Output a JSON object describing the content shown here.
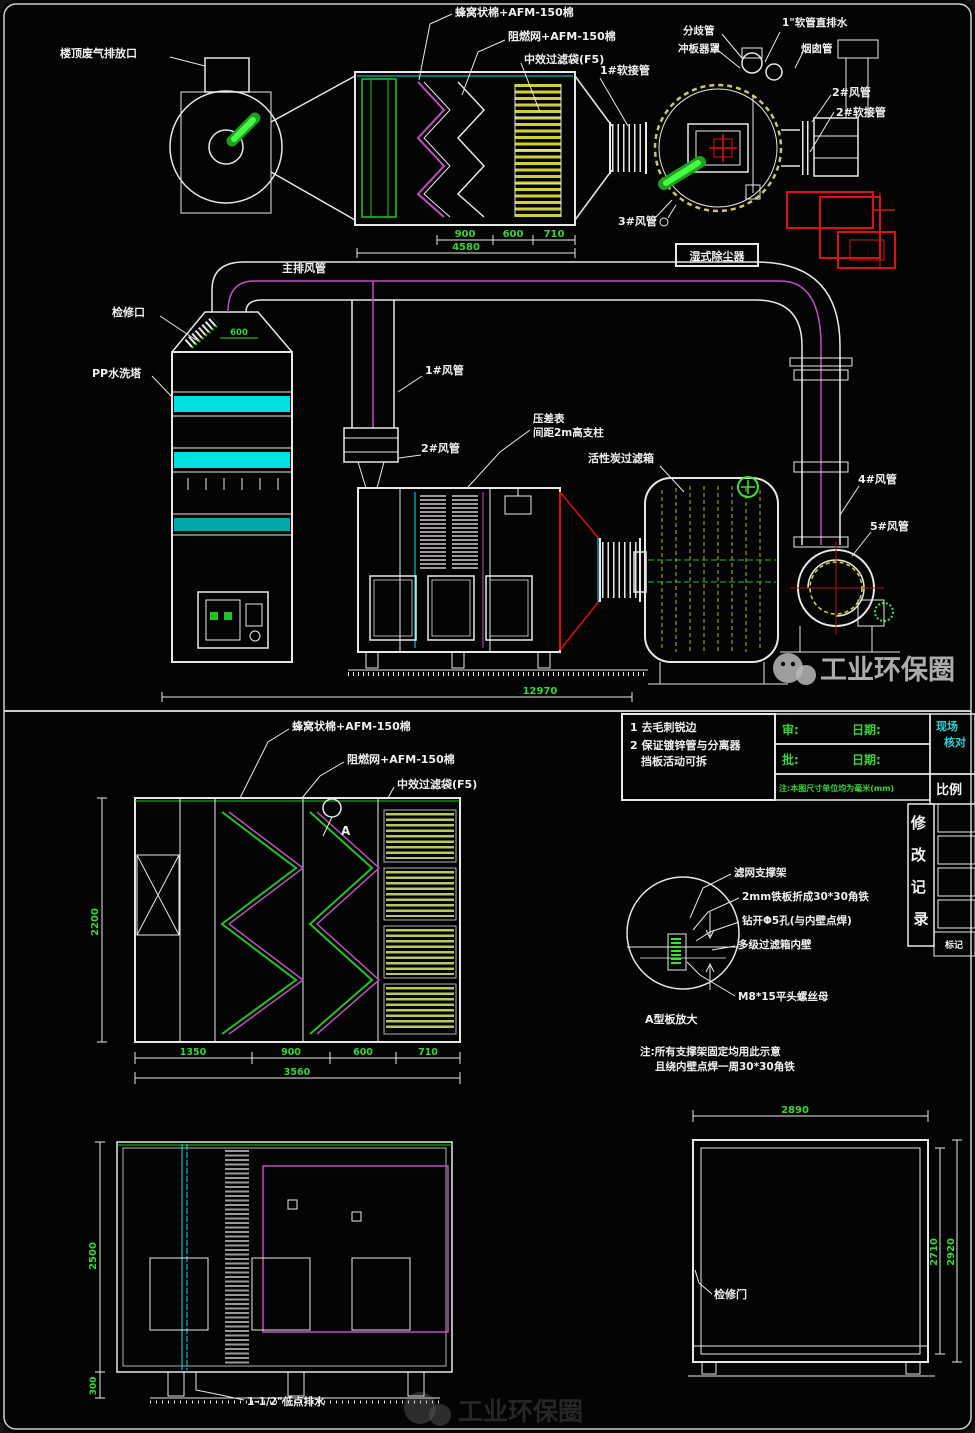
{
  "watermark": {
    "brand": "工业环保圈"
  },
  "top_view": {
    "labels": {
      "roof_outlet": "楼顶废气排放口",
      "honeycomb": "蜂窝状棉+AFM-150棉",
      "flame_net": "阻燃网+AFM-150棉",
      "mid_bag": "中效过滤袋(F5)",
      "soft1": "1#软接管",
      "branch": "分歧管",
      "baffle_cover": "冲板器罩",
      "drain_hose": "1\"软管直排水",
      "chimney": "烟囱管",
      "duct2": "2#风管",
      "soft2": "2#软接管",
      "duct3": "3#风管",
      "tag": "湿式除尘器"
    },
    "dims": {
      "a": "900",
      "b": "600",
      "c": "710",
      "total": "4580"
    }
  },
  "system_view": {
    "labels": {
      "main_duct": "主排风管",
      "hatch": "检修口",
      "tower": "PP水洗塔",
      "duct1": "1#风管",
      "gauge_line1": "压差表",
      "gauge_line2": "间距2m高支柱",
      "duct2": "2#风管",
      "carbon_box": "活性炭过滤箱",
      "duct4": "4#风管",
      "duct5": "5#风管"
    },
    "dims": {
      "hood": "600",
      "total": "12970"
    }
  },
  "notes_block": {
    "line1": "1 去毛刺锐边",
    "line2": "2 保证镀锌管与分离器",
    "line3": "挡板活动可拆"
  },
  "title_block": {
    "review": "审:",
    "date1": "日期:",
    "approve": "批:",
    "date2": "日期:",
    "green_note": "注:本图尺寸单位均为毫米(mm)",
    "scale": "比例",
    "corner_line1": "现场",
    "corner_line2": "核对",
    "revision_chars": [
      "修",
      "改",
      "记",
      "录"
    ],
    "mark": "标记"
  },
  "elevation_view": {
    "labels": {
      "honeycomb": "蜂窝状棉+AFM-150棉",
      "flame_net": "阻燃网+AFM-150棉",
      "mid_bag": "中效过滤袋(F5)",
      "marker": "A"
    },
    "dims": {
      "height": "2200",
      "a": "1350",
      "b": "900",
      "c": "600",
      "d": "710",
      "total": "3560"
    }
  },
  "detail_a": {
    "labels": {
      "support": "滤网支撑架",
      "angle_iron": "2mm铁板折成30*30角铁",
      "hole": "钻开Φ5孔(与内壁点焊)",
      "inner_wall": "多级过滤箱内壁",
      "screw": "M8*15平头螺丝母"
    },
    "caption": "A型板放大",
    "note1": "注:所有支撑架固定均用此示意",
    "note2": "且绕内壁点焊一周30*30角铁"
  },
  "side_elevation": {
    "labels": {
      "drain": "1-1/2\"低点排水"
    },
    "dims": {
      "height": "2500",
      "base": "300"
    }
  },
  "plan_view": {
    "labels": {
      "door": "检修门"
    },
    "dims": {
      "width": "2890",
      "inner": "2710",
      "outer": "2920"
    }
  }
}
